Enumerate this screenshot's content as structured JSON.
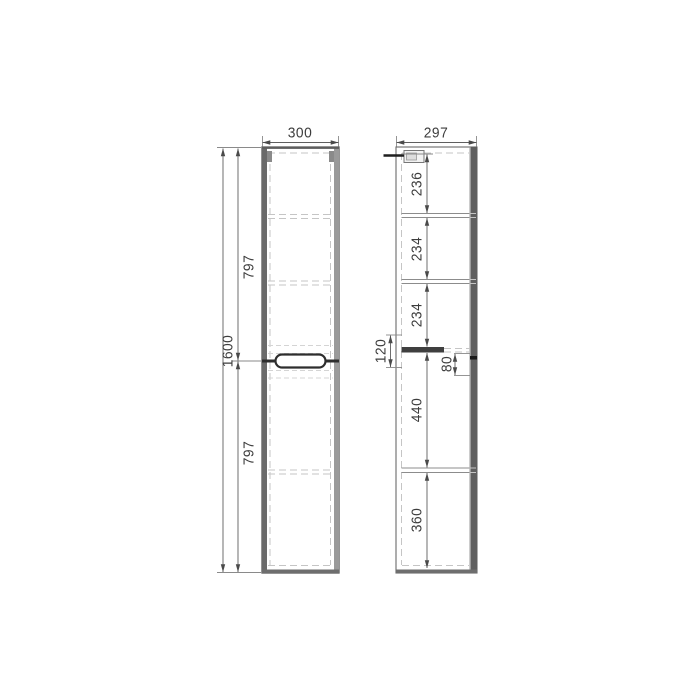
{
  "drawing": {
    "type": "furniture-dimension-drawing",
    "views": 2,
    "front": {
      "width": "300",
      "total_height": "1600",
      "upper_door_height": "797",
      "lower_door_height": "797"
    },
    "side": {
      "depth": "297",
      "section_top": "236",
      "section_second": "234",
      "section_third": "234",
      "handle_zone_height": "120",
      "handle_recess_height": "80",
      "section_fourth": "440",
      "section_bottom": "360"
    },
    "colors": {
      "ink": "#4a4a4a",
      "hidden_line": "#c5c5c5",
      "door_edge": "#5f5f5f",
      "background": "#ffffff"
    }
  }
}
